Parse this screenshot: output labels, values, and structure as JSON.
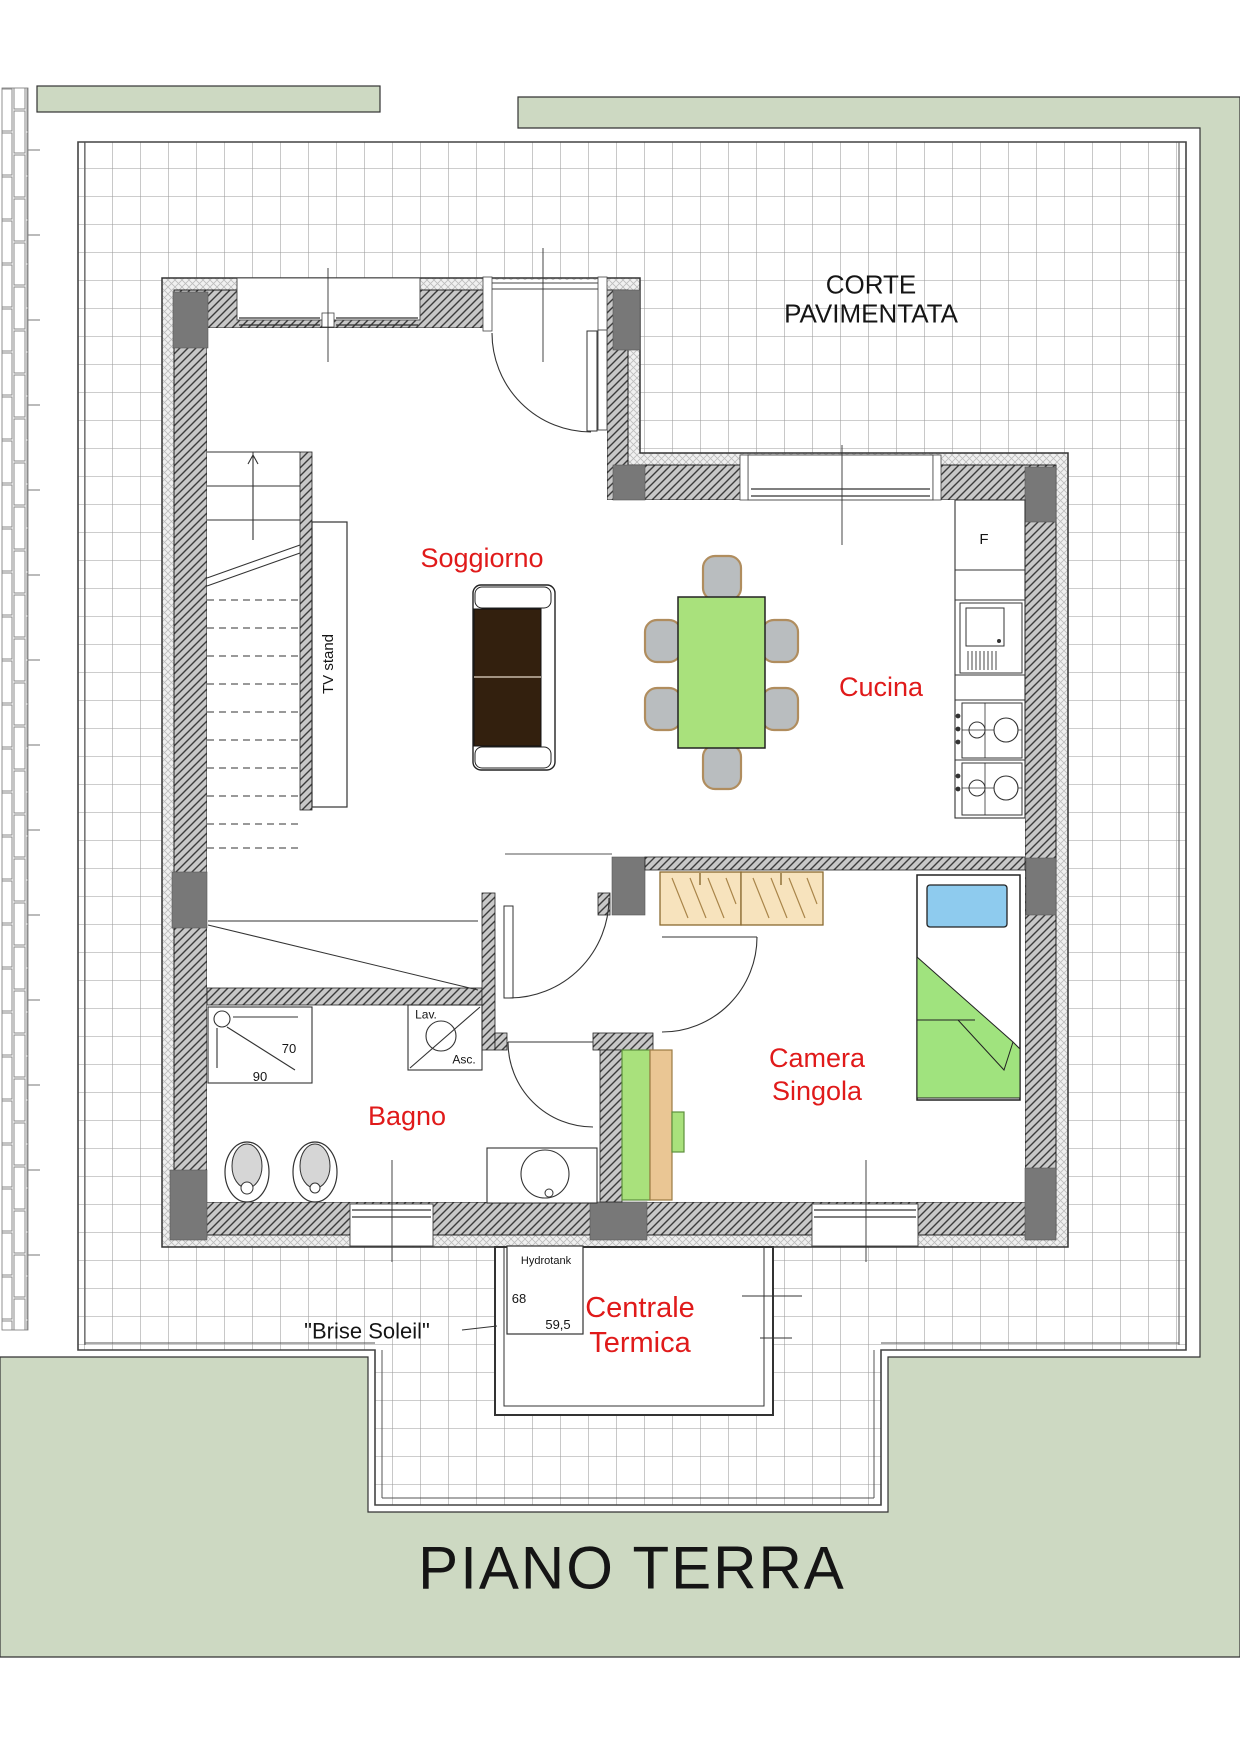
{
  "plan_title": "PIANO TERRA",
  "outdoor": {
    "courtyard_label_line1": "CORTE",
    "courtyard_label_line2": "PAVIMENTATA",
    "brise_soleil_label": "\"Brise Soleil\""
  },
  "rooms": {
    "soggiorno": {
      "label": "Soggiorno"
    },
    "cucina": {
      "label": "Cucina"
    },
    "bagno": {
      "label": "Bagno"
    },
    "camera_singola": {
      "label_line1": "Camera",
      "label_line2": "Singola"
    },
    "centrale_termica": {
      "label_line1": "Centrale",
      "label_line2": "Termica"
    }
  },
  "fixtures": {
    "tv_stand_label": "TV stand",
    "fridge_label": "F",
    "washer_label_top": "Lav.",
    "washer_label_bottom": "Asc.",
    "shower_dim_width": "70",
    "shower_dim_depth": "90",
    "hydrotank_label": "Hydrotank",
    "hydrotank_dim1": "68",
    "hydrotank_dim2": "59,5"
  },
  "colors": {
    "label_red": "#e01a1a",
    "garden_green": "#cdd9c2",
    "furniture_green": "#a9e17c",
    "sofa_brown": "#33200e",
    "pillow_blue": "#8ecbee",
    "wood_tan": "#f7e3bd",
    "wall_gray": "#787878"
  }
}
